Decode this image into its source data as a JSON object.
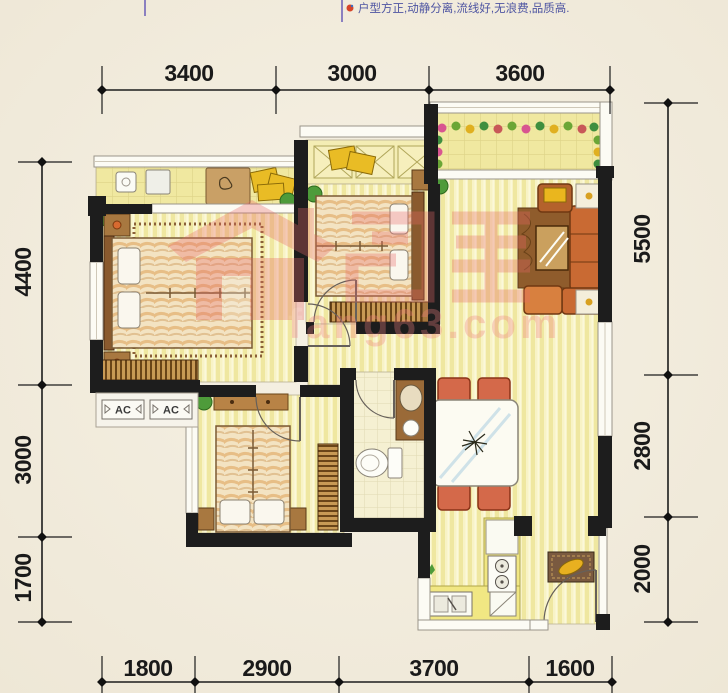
{
  "header": {
    "tagline": "户型方正,动静分离,流线好,无浪费,品质高."
  },
  "dimensions": {
    "top": [
      "3400",
      "3000",
      "3600"
    ],
    "bottom": [
      "1800",
      "2900",
      "3700",
      "1600"
    ],
    "left": [
      "4400",
      "3000",
      "1700"
    ],
    "right": [
      "5500",
      "2800",
      "2000"
    ]
  },
  "ac_units": {
    "ac1": "AC",
    "ac2": "AC"
  },
  "watermark": {
    "domain": "fang63.com"
  },
  "colors": {
    "background": "#f3eee1",
    "wall": "#1d1d1d",
    "floor_stripe": "#f8f3c6",
    "balcony_tile": "#f0e8a0",
    "dimension": "#1a1a1a",
    "tagline": "#4e55a2",
    "watermark_pink": "#e86868",
    "wood": "#b88346",
    "sofa": "#c96a33"
  }
}
